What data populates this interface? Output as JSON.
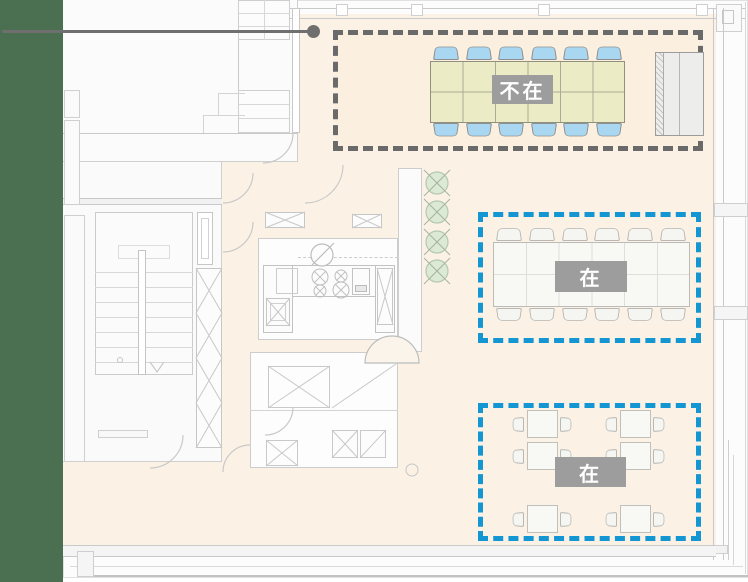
{
  "sidebar": {
    "color": "#4A7051"
  },
  "annotation": {
    "pointer_line_color": "#6F6F6F"
  },
  "status_labels": {
    "absent": "不在",
    "present": "在"
  },
  "zones": [
    {
      "id": "meeting-area-top",
      "label": "不在",
      "status": "absent",
      "border_color": "#6A6A6A",
      "border_style": "dashed",
      "fill_color": "#FBF0DF",
      "table": {
        "type": "conference-table",
        "grid": "6x2",
        "color": "#EBEBC5"
      },
      "chairs": {
        "count": 12,
        "per_side": 6,
        "color": "#A9D6F0"
      },
      "cabinet": true
    },
    {
      "id": "meeting-area-middle",
      "label": "在",
      "status": "present",
      "border_color": "#1496D2",
      "border_style": "dashed",
      "table": {
        "type": "conference-table",
        "grid": "6x2",
        "color": "#F8F8F5"
      },
      "chairs": {
        "count": 12,
        "per_side": 6,
        "color": "#F5F5F2"
      }
    },
    {
      "id": "desk-area-bottom",
      "label": "在",
      "status": "present",
      "border_color": "#1496D2",
      "border_style": "dashed",
      "desks": {
        "count": 6,
        "layout": "2x3"
      },
      "chairs": {
        "count": 12,
        "per_desk": 2,
        "color": "#F5F5F2"
      }
    }
  ],
  "floorplan": {
    "floor_color": "#FBF2E5",
    "wall_color": "#C9C9C9",
    "trees": {
      "count": 4,
      "color": "#DCE9D5"
    },
    "rooms": [
      "stairwell",
      "kitchen",
      "storage"
    ]
  }
}
